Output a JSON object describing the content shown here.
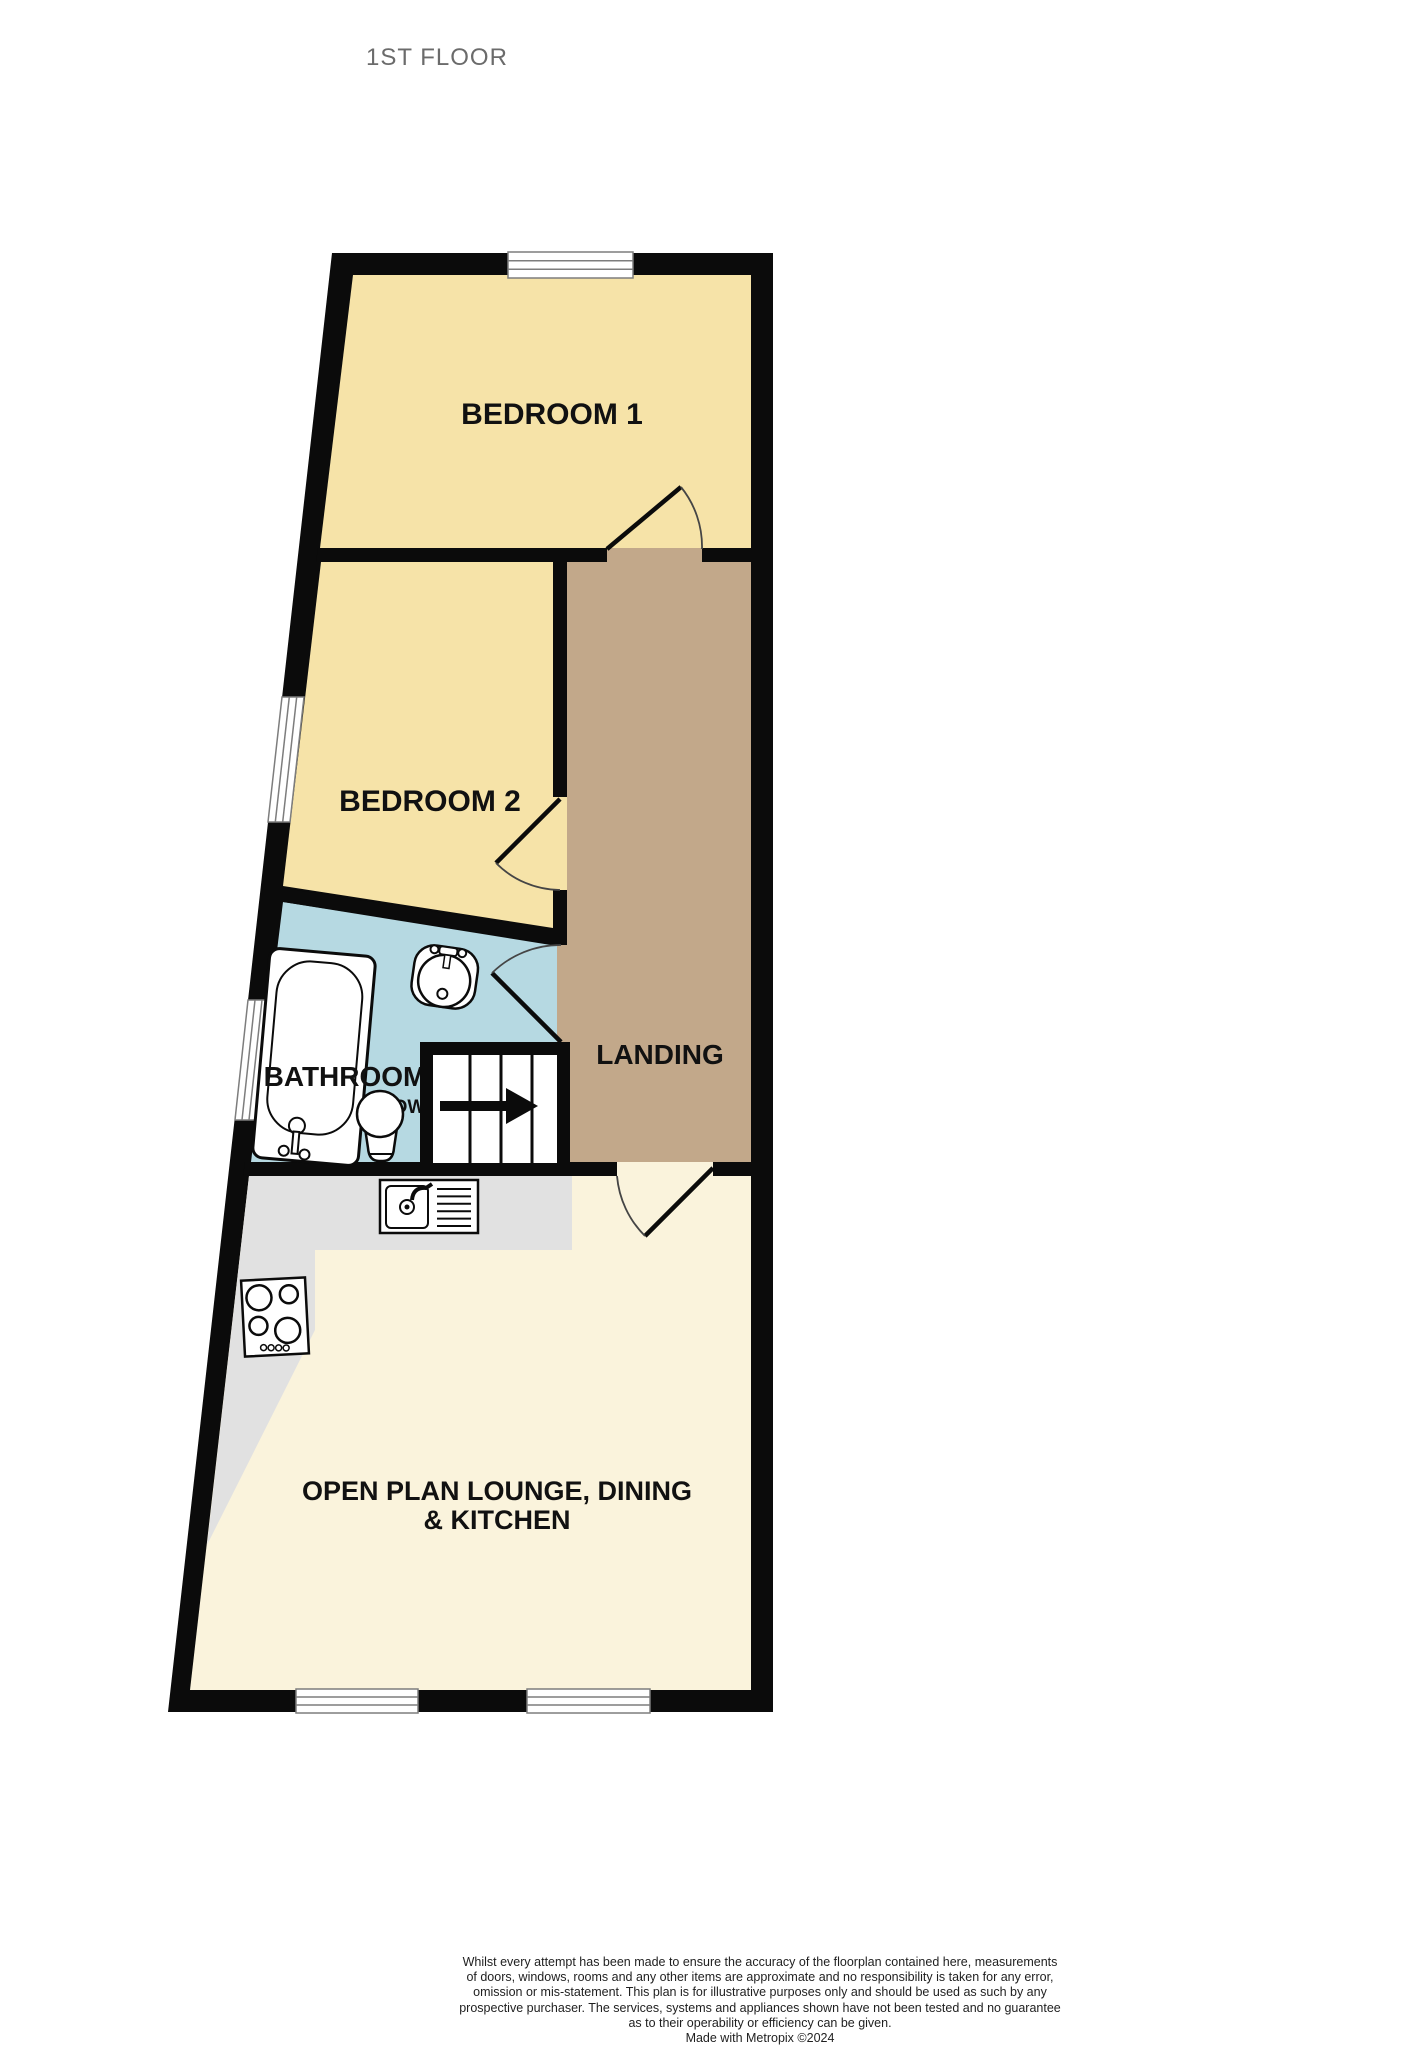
{
  "title": "1ST FLOOR",
  "rooms": {
    "bedroom1": "BEDROOM 1",
    "bedroom2": "BEDROOM 2",
    "landing": "LANDING",
    "bathroom": "BATHROOM",
    "lounge_line1": "OPEN PLAN LOUNGE, DINING",
    "lounge_line2": "& KITCHEN"
  },
  "stairs": {
    "direction_label": "DOWN"
  },
  "fixtures": [
    "bathtub",
    "washbasin",
    "toilet",
    "kitchen-sink-drainer",
    "hob",
    "staircase",
    "doors",
    "windows"
  ],
  "colors": {
    "wall": "#0b0b0b",
    "bedroom": "#f6e3a8",
    "landing": "#c2a88a",
    "bathroom": "#b6d9e2",
    "lounge": "#faf3dc",
    "worktop": "#e1e1e1",
    "window": "#ffffff",
    "fixture": "#ffffff"
  },
  "footer": {
    "lines": [
      "Whilst every attempt has been made to ensure the accuracy of the floorplan contained here, measurements",
      "of doors, windows, rooms and any other items are approximate and no responsibility is taken for any error,",
      "omission or mis-statement. This plan is for illustrative purposes only and should be used as such by any",
      "prospective purchaser. The services, systems and appliances shown have not been tested and no guarantee",
      "as to their operability or efficiency can be given.",
      "Made with Metropix ©2024"
    ]
  }
}
